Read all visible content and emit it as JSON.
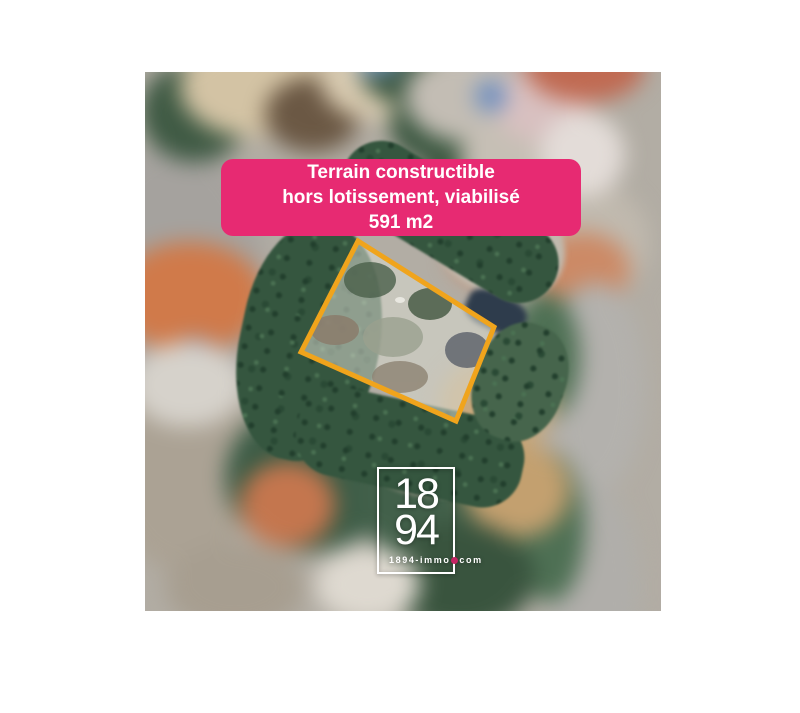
{
  "banner": {
    "line1": "Terrain constructible",
    "line2": "hors lotissement, viabilisé",
    "line3": "591 m2",
    "bg_color": "#E72A72",
    "text_color": "#FFFFFF"
  },
  "plot_outline": {
    "color": "#F0A41C",
    "shape": "quadrilateral"
  },
  "logo": {
    "digits_top": "18",
    "digits_bottom": "94",
    "website_prefix": "1894-immo",
    "website_suffix": "com",
    "dot_color": "#C42563",
    "frame_color": "#FFFFFF"
  }
}
